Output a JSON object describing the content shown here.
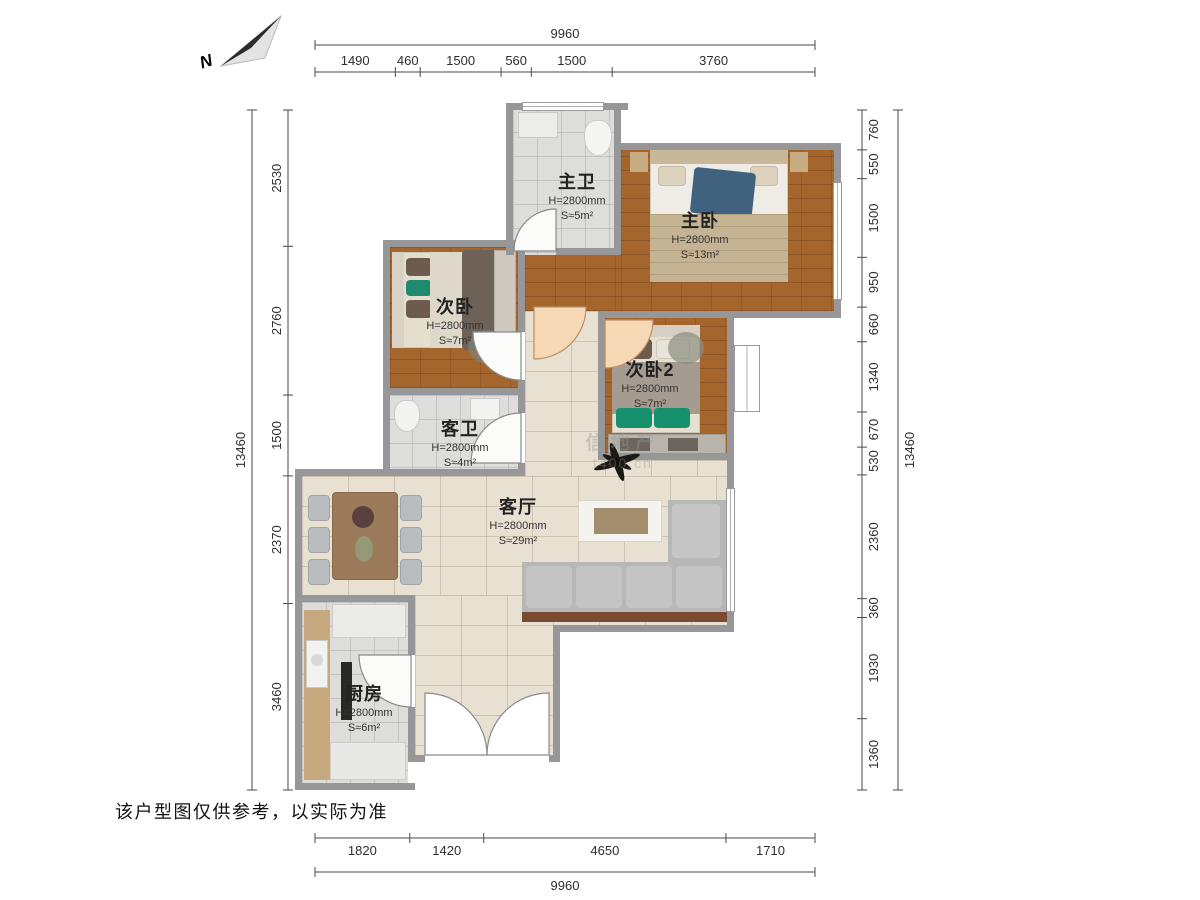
{
  "north_label": "N",
  "disclaimer": "该户型图仅供参考，以实际为准",
  "watermark": {
    "line1": "信地产",
    "line2": "t400.cn"
  },
  "rooms": [
    {
      "id": "master-bath",
      "name": "主卫",
      "height": "H=2800mm",
      "area": "S≈5m²"
    },
    {
      "id": "master-bedroom",
      "name": "主卧",
      "height": "H=2800mm",
      "area": "S≈13m²"
    },
    {
      "id": "bedroom-2",
      "name": "次卧",
      "height": "H=2800mm",
      "area": "S≈7m²"
    },
    {
      "id": "bedroom-3",
      "name": "次卧2",
      "height": "H=2800mm",
      "area": "S≈7m²"
    },
    {
      "id": "guest-bath",
      "name": "客卫",
      "height": "H=2800mm",
      "area": "S≈4m²"
    },
    {
      "id": "living-room",
      "name": "客厅",
      "height": "H=2800mm",
      "area": "S≈29m²"
    },
    {
      "id": "kitchen",
      "name": "厨房",
      "height": "H=2800mm",
      "area": "S≈6m²"
    }
  ],
  "dimensions": {
    "top": {
      "total": "9960",
      "segments": [
        "1490",
        "460",
        "1500",
        "560",
        "1500",
        "3760"
      ]
    },
    "bottom": {
      "total": "9960",
      "segments": [
        "1820",
        "1420",
        "4650",
        "1710"
      ]
    },
    "left": {
      "total": "13460",
      "segments": [
        "2530",
        "2760",
        "1500",
        "2370",
        "3460"
      ]
    },
    "right": {
      "total": "13460",
      "segments": [
        "760",
        "550",
        "1500",
        "950",
        "660",
        "1340",
        "670",
        "530",
        "2360",
        "360",
        "1930",
        "1360"
      ]
    }
  },
  "colors": {
    "wall": "#97979a",
    "wood_floor": "#a5662d",
    "tile_floor": "#dddddb",
    "living_floor": "#e8e1d2",
    "sofa_gray": "#bcbcbc",
    "sofa_frame_brown": "#7a4a31",
    "teal_accent": "#17906e",
    "blue_accent": "#40627f",
    "door_peach": "#f6d8b5"
  }
}
